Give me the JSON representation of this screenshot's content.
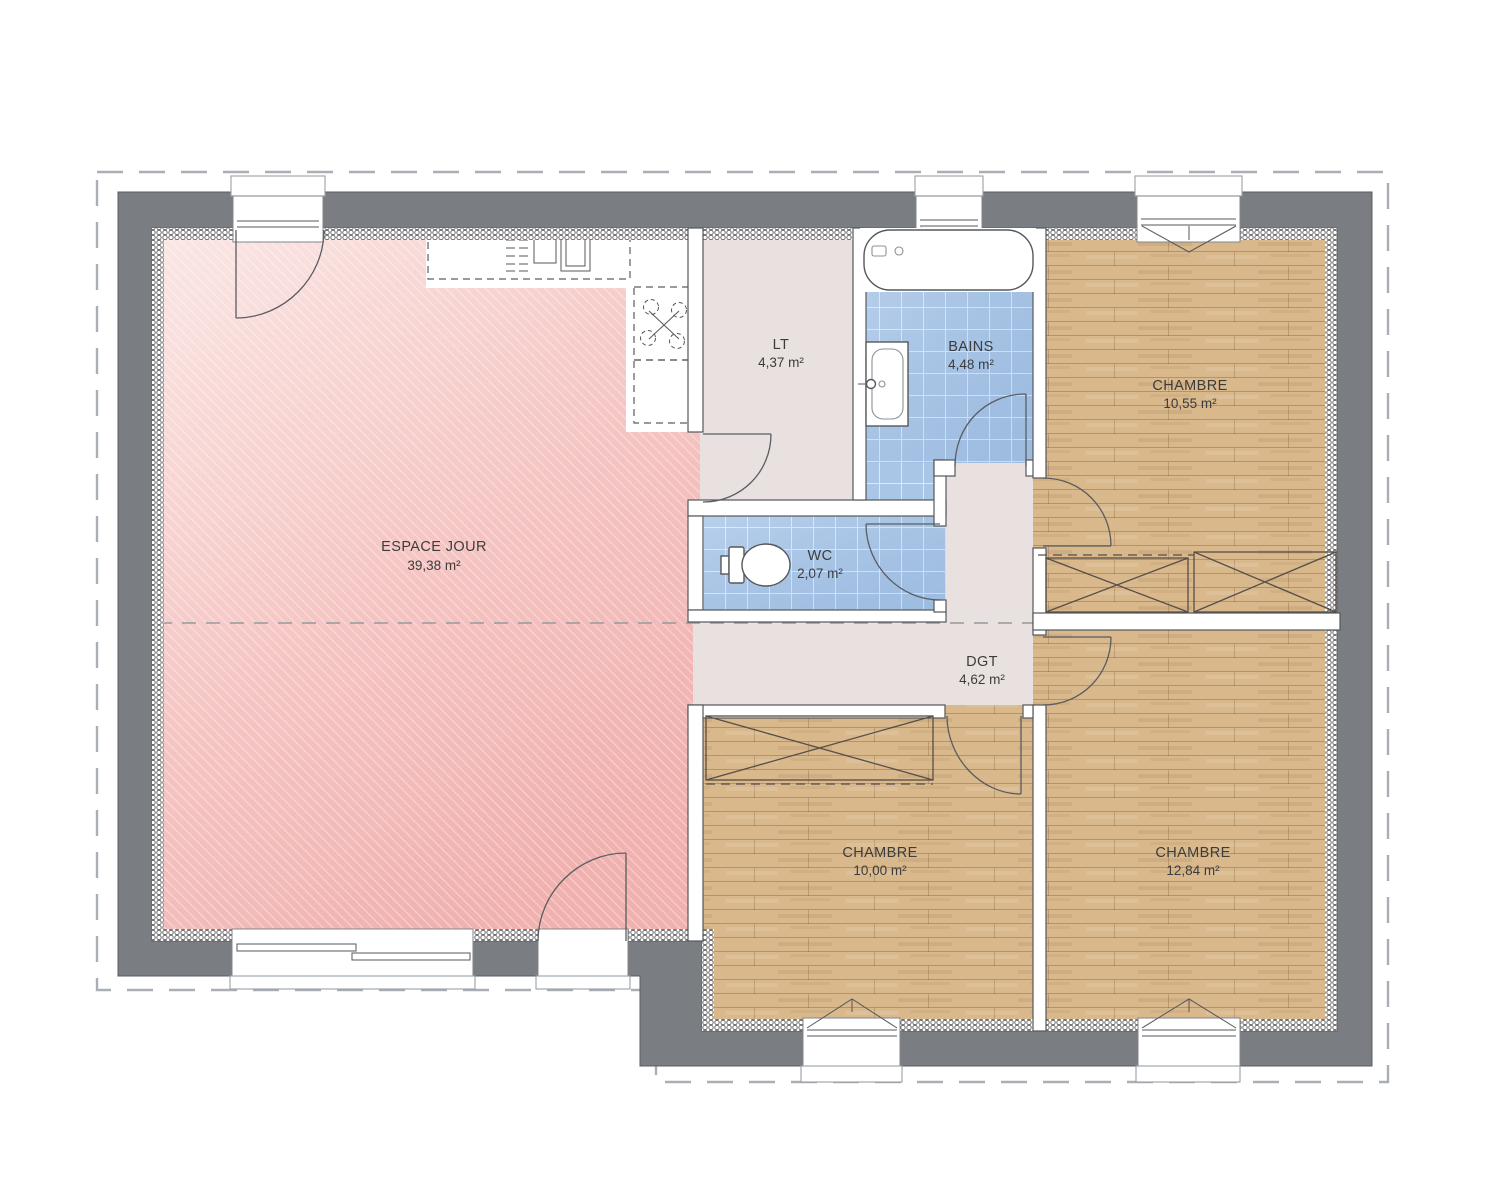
{
  "plan": {
    "type": "floor-plan",
    "rooms": [
      {
        "id": "espace-jour",
        "label": "ESPACE JOUR",
        "area": "39,38 m²"
      },
      {
        "id": "lt",
        "label": "LT",
        "area": "4,37 m²"
      },
      {
        "id": "bains",
        "label": "BAINS",
        "area": "4,48 m²"
      },
      {
        "id": "chambre-1",
        "label": "CHAMBRE",
        "area": "10,55 m²"
      },
      {
        "id": "wc",
        "label": "WC",
        "area": "2,07 m²"
      },
      {
        "id": "dgt",
        "label": "DGT",
        "area": "4,62 m²"
      },
      {
        "id": "chambre-2",
        "label": "CHAMBRE",
        "area": "10,00 m²"
      },
      {
        "id": "chambre-3",
        "label": "CHAMBRE",
        "area": "12,84 m²"
      }
    ],
    "colors": {
      "wall_gray": "#7a7d82",
      "living_pink": "#f4c2c0",
      "tile_blue": "#a9c6e7",
      "wood": "#d9b88c",
      "hall_beige": "#e8e1df",
      "line_dark": "#54575b",
      "boundary_dash": "#aaafb5"
    }
  }
}
